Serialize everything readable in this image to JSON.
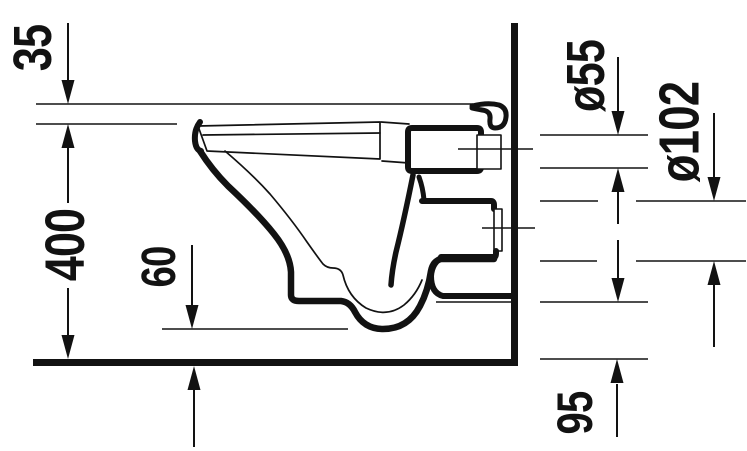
{
  "diagram": {
    "type": "technical-dimension-drawing",
    "labels": {
      "seat_offset": "35",
      "rim_height": "400",
      "bowl_clearance": "60",
      "flush_pipe_diameter": "ø55",
      "outlet_diameter": "ø102",
      "outlet_height": "95"
    },
    "colors": {
      "ink": "#121212",
      "background": "#ffffff"
    }
  }
}
